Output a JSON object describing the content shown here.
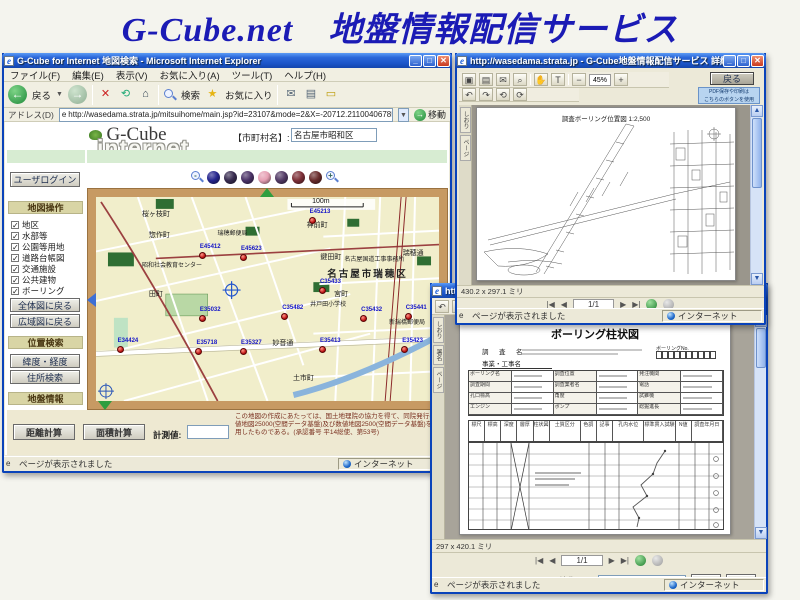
{
  "page": {
    "heading": "G-Cube.net　地盤情報配信サービス",
    "heading_color": "#1b1bb5"
  },
  "status": {
    "loaded": "ページが表示されました",
    "zone": "インターネット"
  },
  "main_window": {
    "title": "G-Cube for Internet 地図検索 - Microsoft Internet Explorer",
    "menu": [
      "ファイル(F)",
      "編集(E)",
      "表示(V)",
      "お気に入り(A)",
      "ツール(T)",
      "ヘルプ(H)"
    ],
    "toolbar": {
      "back": "戻る",
      "search": "検索",
      "favorites": "お気に入り"
    },
    "address": {
      "label": "アドレス(D)",
      "url": "http://wasedama.strata.jp/mitsuihome/main.jsp?id=23107&mode=2&X=-20712.2110040678568&Y=-97237.7765404417",
      "go": "移動"
    },
    "logo": {
      "brand": "G-Cube",
      "sub": "internet"
    },
    "city": {
      "label": "【市町村名】:",
      "value": "名古屋市昭和区"
    },
    "sidebar": {
      "login": "ユーザログイン",
      "map_ops": "地図操作",
      "layers": [
        "地区",
        "水部等",
        "公園等用地",
        "道路台帳図",
        "交通施設",
        "公共建物",
        "ボーリング"
      ],
      "back_whole": "全体図に戻る",
      "back_wide": "広域図に戻る",
      "pos_search": "位置検索",
      "latlon": "緯度・経度",
      "addr_search": "住所検索",
      "geo_info": "地盤情報",
      "boring_ledger": "ボーリング台帳",
      "reg_xml": "登録(XML)",
      "reg_pdf": "登録(PDF)"
    },
    "map": {
      "scale": "100m",
      "zoom_ball_colors": [
        "#26268e",
        "#382c50",
        "#4c3468",
        "#e6a0b4",
        "#533b66",
        "#7e3038",
        "#682c2c"
      ],
      "places": [
        {
          "t": "桜ヶ枝町",
          "x": 14,
          "y": 8,
          "c": ""
        },
        {
          "t": "惣作町",
          "x": 16,
          "y": 18,
          "c": ""
        },
        {
          "t": "瑞穂郵便局",
          "x": 36,
          "y": 17,
          "c": "sm"
        },
        {
          "t": "昭和社会教育センター",
          "x": 14,
          "y": 33,
          "c": "sm"
        },
        {
          "t": "田町",
          "x": 16,
          "y": 47,
          "c": ""
        },
        {
          "t": "神前町",
          "x": 62,
          "y": 13,
          "c": ""
        },
        {
          "t": "鍵田町",
          "x": 66,
          "y": 29,
          "c": ""
        },
        {
          "t": "名古屋国道工事事務所",
          "x": 73,
          "y": 30,
          "c": "sm"
        },
        {
          "t": "瑞穂通",
          "x": 90,
          "y": 27,
          "c": ""
        },
        {
          "t": "名古屋市瑞穂区",
          "x": 68,
          "y": 36,
          "c": "big"
        },
        {
          "t": "宮町",
          "x": 70,
          "y": 47,
          "c": ""
        },
        {
          "t": "井戸田小学校",
          "x": 63,
          "y": 52,
          "c": "sm"
        },
        {
          "t": "新瑞橋郵便局",
          "x": 86,
          "y": 61,
          "c": "sm"
        },
        {
          "t": "妙音通",
          "x": 52,
          "y": 71,
          "c": ""
        },
        {
          "t": "土市町",
          "x": 58,
          "y": 88,
          "c": ""
        }
      ],
      "borings": [
        {
          "id": "E45412",
          "x": 30,
          "y": 27
        },
        {
          "id": "E45623",
          "x": 42,
          "y": 28
        },
        {
          "id": "E45213",
          "x": 62,
          "y": 10
        },
        {
          "id": "C35433",
          "x": 65,
          "y": 44
        },
        {
          "id": "E35032",
          "x": 30,
          "y": 58
        },
        {
          "id": "E34424",
          "x": 6,
          "y": 73
        },
        {
          "id": "E35718",
          "x": 29,
          "y": 74
        },
        {
          "id": "E35327",
          "x": 42,
          "y": 74
        },
        {
          "id": "C35482",
          "x": 54,
          "y": 57
        },
        {
          "id": "C35432",
          "x": 77,
          "y": 58
        },
        {
          "id": "C35441",
          "x": 90,
          "y": 57
        },
        {
          "id": "E35413",
          "x": 65,
          "y": 73
        },
        {
          "id": "E35423",
          "x": 89,
          "y": 73
        }
      ]
    },
    "measure": {
      "distance": "距離計算",
      "area": "面積計算",
      "label": "計測値:"
    },
    "disclaimer": "この地図の作成にあたっては、国土地理院の協力を得て、同院発行の数値地図25000(空間データ基盤)及び数値地図2500(空間データ基盤)を使用したものである。(承認番号 平14総使、第53号)"
  },
  "pdf_window": {
    "title": "http://wasedama.strata.jp - G-Cube地盤情報配信サービス 詳細平面図 - Microsoft Internet Explorer",
    "back_btn": "戻る",
    "note_line1": "PDF保存や印刷は",
    "note_line2": "こちらのボタンを使用",
    "zoom_level": "45%",
    "doc_title": "調査ボーリング位置図 1:2,500",
    "doc_size": "430.2 x 297.1 ミリ",
    "page_nav": "1/1"
  },
  "boring_window": {
    "title": "http://wasedama.strata.jp - G-Cube地盤情報配信サービス 柱状図 - Microsoft Internet Explorer",
    "picture_tasks": "ピクチャタスク",
    "doc_title": "ボーリング柱状図",
    "survey_label": "調　査　名",
    "work_label": "事業・工事名",
    "boring_no_label": "ボーリングNo.",
    "form_labels": [
      "ボーリング名",
      "調査位置",
      "発注機関",
      "調査期間",
      "調査業者名",
      "電話",
      "孔口標高",
      "角度",
      "試錐機",
      "エンジン",
      "ポンプ",
      "総掘進長"
    ],
    "col_headers": [
      "標尺",
      "標高",
      "深度",
      "層厚",
      "柱状図",
      "土質区分",
      "色調",
      "記事",
      "孔内水位",
      "標準貫入試験",
      "N値",
      "調査年月日"
    ],
    "doc_size": "297 x 420.1 ミリ",
    "page_nav": "1/1",
    "edit_key_label": "編集キー",
    "edit_btn": "編集",
    "delete_btn": "削除"
  }
}
